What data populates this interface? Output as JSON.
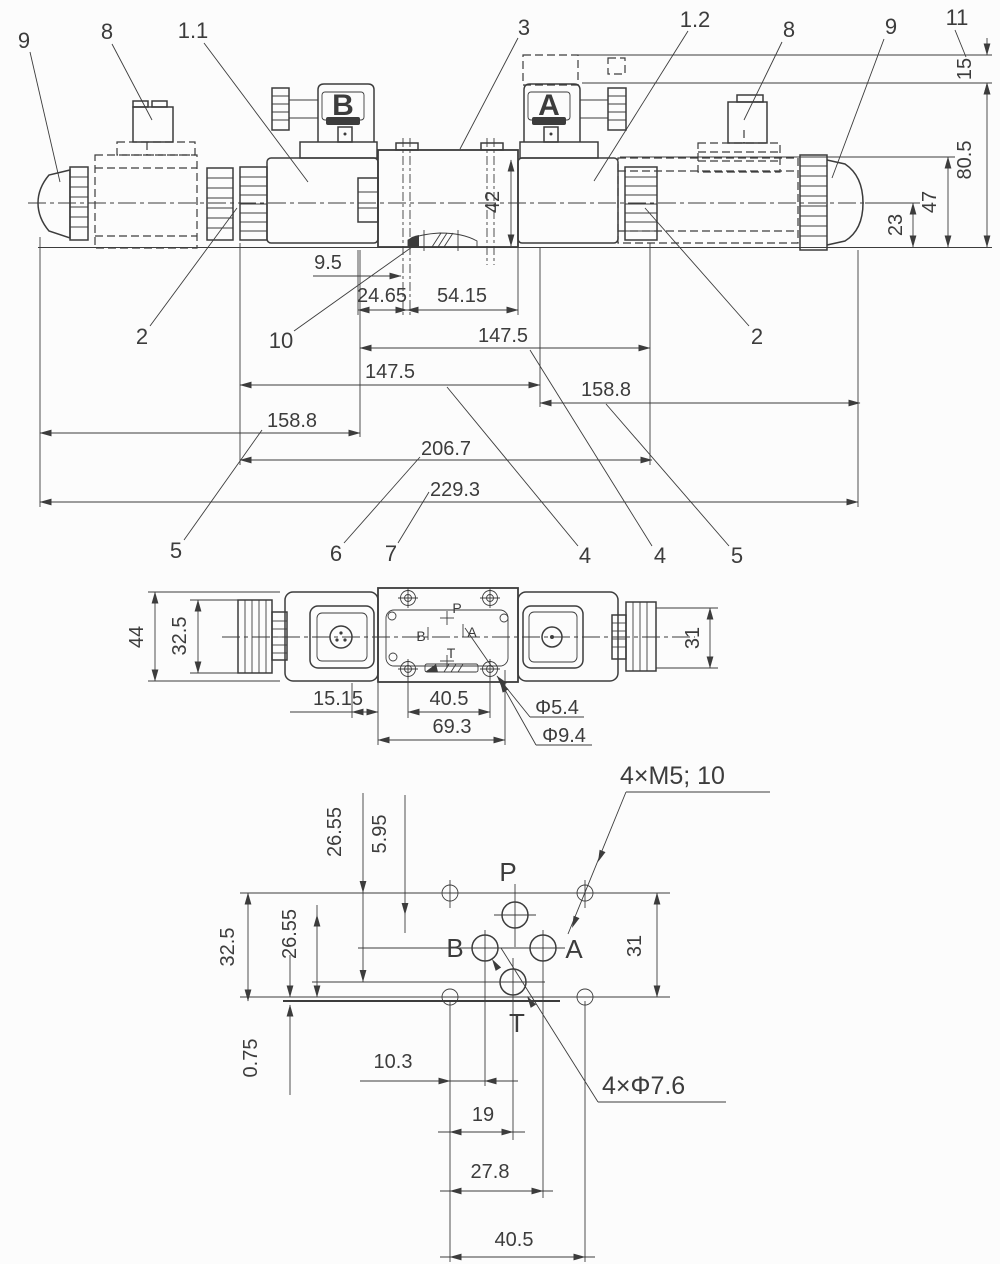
{
  "front_view": {
    "callout_9_left": "9",
    "callout_8_left": "8",
    "callout_1_1": "1.1",
    "callout_3": "3",
    "callout_1_2": "1.2",
    "callout_8_right": "8",
    "callout_9_right": "9",
    "callout_11": "11",
    "callout_2_left": "2",
    "callout_10": "10",
    "callout_2_right": "2",
    "callout_5_left": "5",
    "callout_6": "6",
    "callout_7": "7",
    "callout_4_a": "4",
    "callout_4_b": "4",
    "callout_5_right": "5",
    "connector_b": "B",
    "connector_a": "A",
    "dim_9_5": "9.5",
    "dim_24_65": "24.65",
    "dim_54_15": "54.15",
    "dim_42": "42",
    "dim_147_5_upper": "147.5",
    "dim_147_5_lower": "147.5",
    "dim_158_8_right": "158.8",
    "dim_158_8_left": "158.8",
    "dim_206_7": "206.7",
    "dim_229_3": "229.3",
    "dim_15": "15",
    "dim_80_5": "80.5",
    "dim_47": "47",
    "dim_23": "23"
  },
  "plan_view": {
    "dim_44": "44",
    "dim_32_5": "32.5",
    "dim_31": "31",
    "dim_15_15": "15.15",
    "dim_40_5": "40.5",
    "dim_69_3": "69.3",
    "dim_dia_5_4": "Φ5.4",
    "dim_dia_9_4": "Φ9.4",
    "port_p": "P",
    "port_b": "B",
    "port_a": "A",
    "port_t": "T"
  },
  "mounting_view": {
    "note_threads": "4×M5; 10",
    "note_ports": "4×Φ7.6",
    "dim_26_55_top": "26.55",
    "dim_5_95": "5.95",
    "dim_32_5": "32.5",
    "dim_26_55_left": "26.55",
    "dim_0_75": "0.75",
    "dim_10_3": "10.3",
    "dim_19": "19",
    "dim_27_8": "27.8",
    "dim_40_5": "40.5",
    "dim_31": "31",
    "port_p": "P",
    "port_b": "B",
    "port_a": "A",
    "port_t": "T"
  }
}
